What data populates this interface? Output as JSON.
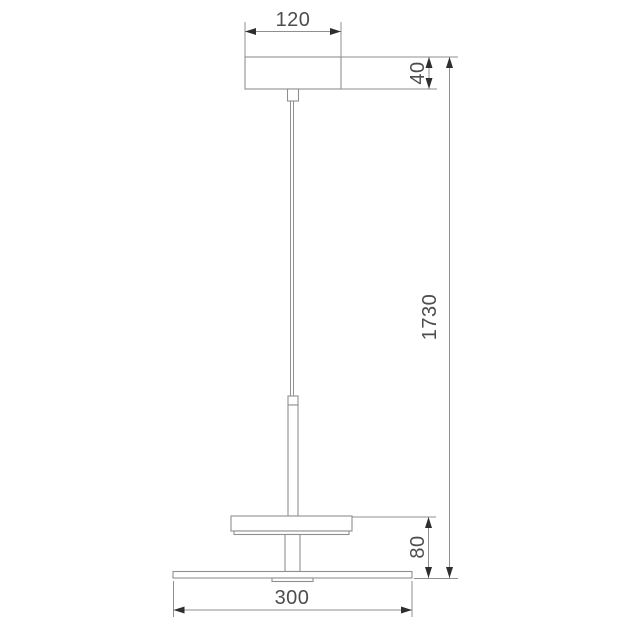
{
  "diagram": {
    "type": "technical-dimension-drawing",
    "subject": "pendant lamp side elevation with dimensions",
    "units_shown": "none (bare numbers, millimetres implied)",
    "dimensions": {
      "canopy_width": {
        "label": "120",
        "orientation": "horizontal",
        "measures": "ceiling canopy width"
      },
      "canopy_height": {
        "label": "40",
        "orientation": "vertical",
        "measures": "ceiling canopy height"
      },
      "overall_drop": {
        "label": "1730",
        "orientation": "vertical",
        "measures": "overall suspension height from canopy top to base disc"
      },
      "shade_height": {
        "label": "80",
        "orientation": "vertical",
        "measures": "height from base disc to top of small disc shade"
      },
      "base_width": {
        "label": "300",
        "orientation": "horizontal",
        "measures": "large bottom disc diameter"
      }
    },
    "parts": [
      "ceiling canopy",
      "cable connector block",
      "suspension cable (double line)",
      "rod with top cap",
      "small disc shade with lip",
      "lower stem",
      "large flat base disc",
      "under-disc fitting"
    ],
    "colors": {
      "background": "#ffffff",
      "line": "#8f8f8f",
      "arrow": "#2e2e2e",
      "text": "#4d4d4d"
    }
  }
}
